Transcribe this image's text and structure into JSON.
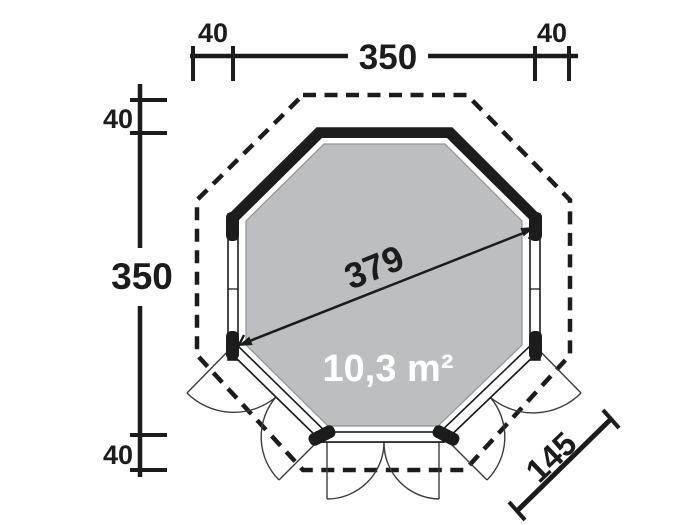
{
  "plan": {
    "area_label": "10,3 m²",
    "diagonal_label": "379",
    "door_width_label": "145",
    "top_dimension": {
      "overhang_left": "40",
      "width": "350",
      "overhang_right": "40"
    },
    "side_dimension": {
      "overhang_top": "40",
      "depth": "350",
      "overhang_bottom": "40"
    },
    "colors": {
      "line": "#1c1c1c",
      "floor": "#bcbec0",
      "floor_outline": "#909396",
      "door_line": "#3c3c3c",
      "area_text": "#ffffff",
      "background": "#ffffff"
    }
  }
}
